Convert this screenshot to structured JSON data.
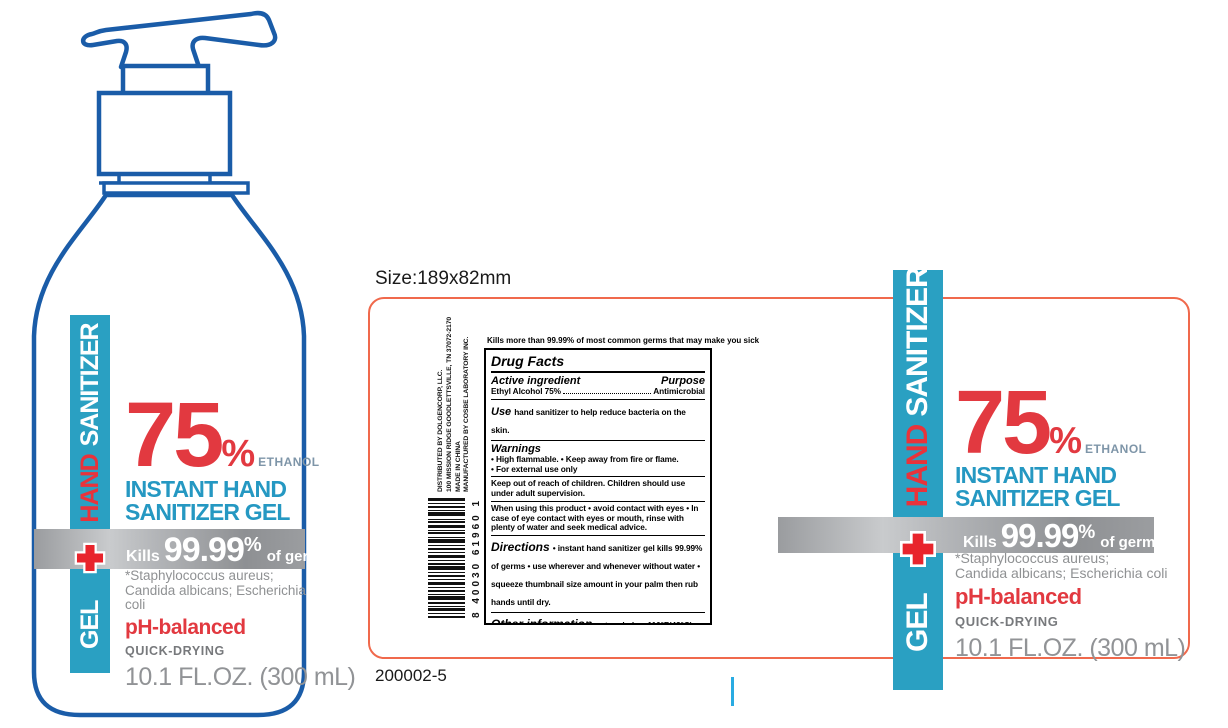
{
  "size_note": "Size:189x82mm",
  "part_number": "200002-5",
  "colors": {
    "teal": "#2aa0c2",
    "brand_red": "#e23940",
    "title_blue": "#2598c2",
    "bottle_outline_blue": "#1a5ca8",
    "label_border_orange": "#f0694c",
    "gray_text": "#8f9193",
    "cursor_blue": "#29abe2"
  },
  "brand": {
    "band_gel": "GEL",
    "band_hand": "HAND",
    "band_sanitizer": "SANITIZER",
    "pct": "75",
    "pct_sign": "%",
    "ethanol": "ETHANOL",
    "title_line1": "INSTANT HAND",
    "title_line2": "SANITIZER GEL",
    "kills_prefix": "Kills",
    "kills_value": "99.99",
    "kills_pct": "%",
    "kills_suffix": "of germs*",
    "germs_note_line1": "*Staphylococcus aureus;",
    "germs_note_line2": "Candida albicans; Escherichia coli",
    "ph": "pH-balanced",
    "quick": "QUICK-DRYING",
    "volume": "10.1 FL.OZ. (300 mL)"
  },
  "label_panel": {
    "distributor_lines": [
      "DISTRIBUTED BY DOLGENCORP, LLC.",
      "100 MISSION RIDGE GOODLETTSVILLE, TN 37072-2170",
      "MADE IN CHINA",
      "MANUFACTURED BY COSBE LABORATORY INC."
    ],
    "barcode_number": "8 40030 61960 1",
    "tagline": "Kills more than 99.99% of most common germs that may make you sick",
    "drug_facts": {
      "title": "Drug Facts",
      "active_header": "Active ingredient",
      "purpose_header": "Purpose",
      "active_name": "Ethyl Alcohol 75%",
      "purpose_value": "Antimicrobial",
      "use_label": "Use",
      "use_text": "hand sanitizer to help reduce bacteria on the skin.",
      "warnings_label": "Warnings",
      "warnings_bullet1": "• High flammable. • Keep away from fire or flame.",
      "warnings_bullet2": "• For external use only",
      "keep_out": "Keep out of reach of children. Children should use under adult supervision.",
      "when_using": "When using this product • avoid contact with eyes • In case of eye contact with eyes or mouth, rinse with plenty of water and seek medical advice.",
      "directions_label": "Directions",
      "directions_text": "• instant hand sanitizer gel kills 99.99% of germs • use wherever and whenever without water • squeeze thumbnail size amount in your palm then rub hands until dry.",
      "other_label": "Other information",
      "other_text": "• store below 110°F(43°C)  • may discolour certain fabric or surfaces.",
      "inactive_label": "Inactive ingredients",
      "inactive_text": "aloe barbadensis leaf extract, artemisia argyi leaf extract, butylene glycol, carbomer,  cnidium monnieri fruit extract, fragrance, glycerin, sargassum fusiforme extract, triethanolamine, water (aqua)."
    }
  }
}
